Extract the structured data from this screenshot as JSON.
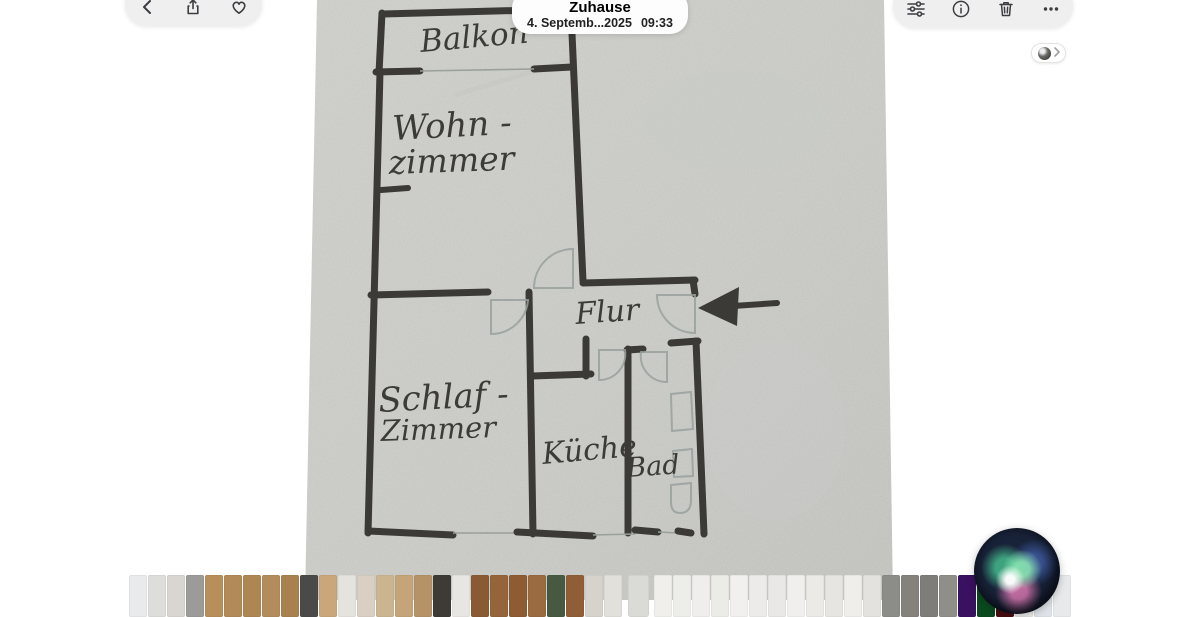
{
  "header": {
    "title": "Zuhause",
    "date_label": "4. Septemb...2025",
    "time_label": "09:33",
    "left_toolbar_icons": [
      "back-icon",
      "share-icon",
      "favorite-heart-icon"
    ],
    "right_toolbar_icons": [
      "adjust-sliders-icon",
      "info-icon",
      "trash-icon",
      "more-ellipsis-icon"
    ],
    "badge_icons": [
      "lookup-icon",
      "chevron-right-icon"
    ]
  },
  "colors": {
    "pill_bg": "#efeff0",
    "icon": "#3e3e42",
    "paper": "#d8d9d5",
    "paper_dark": "#cfd0cc",
    "ink": "#3b3a36",
    "pencil": "#98a09e",
    "hand_ink": "#3c3b35"
  },
  "floor_plan": {
    "rooms": {
      "balkon": "Balkon",
      "wohnzimmer_1": "Wohn -",
      "wohnzimmer_2": "zimmer",
      "flur": "Flur",
      "schlafzimmer_1": "Schlaf -",
      "schlafzimmer_2": "Zimmer",
      "kueche": "Küche",
      "bad": "Bad"
    },
    "annotations": {
      "entrance_arrow_direction": "left"
    }
  },
  "filmstrip": {
    "selected_index": 26,
    "thumbnails": [
      "#e9eaec",
      "#dddddb",
      "#d9d5d0",
      "#9b9b99",
      "#b78f5a",
      "#b18a58",
      "#ad8654",
      "#b28c5c",
      "#a8814f",
      "#4a4a48",
      "#c9a77a",
      "#e5e3de",
      "#d9cfc2",
      "#cbb591",
      "#c4a478",
      "#b69268",
      "#3e3a36",
      "#e8e6e2",
      "#8a5a33",
      "#94643a",
      "#8d5c32",
      "#9a6a40",
      "#475941",
      "#8f5e36",
      "#d6d3cd",
      "#e2e0db",
      "#dadbd7",
      "#f0efec",
      "#ededea",
      "#efeeec",
      "#ebebe8",
      "#f1f0ee",
      "#ecebe9",
      "#e9e8e6",
      "#f0efed",
      "#eceae7",
      "#e7e5e2",
      "#efeeeb",
      "#e4e2df",
      "#8c8c88",
      "#85827c",
      "#7e7d79",
      "#908e89",
      "#3a1060",
      "#0b4a1e",
      "#4a0e12",
      "#efefed",
      "#dfe3e8",
      "#e8e9eb"
    ]
  }
}
